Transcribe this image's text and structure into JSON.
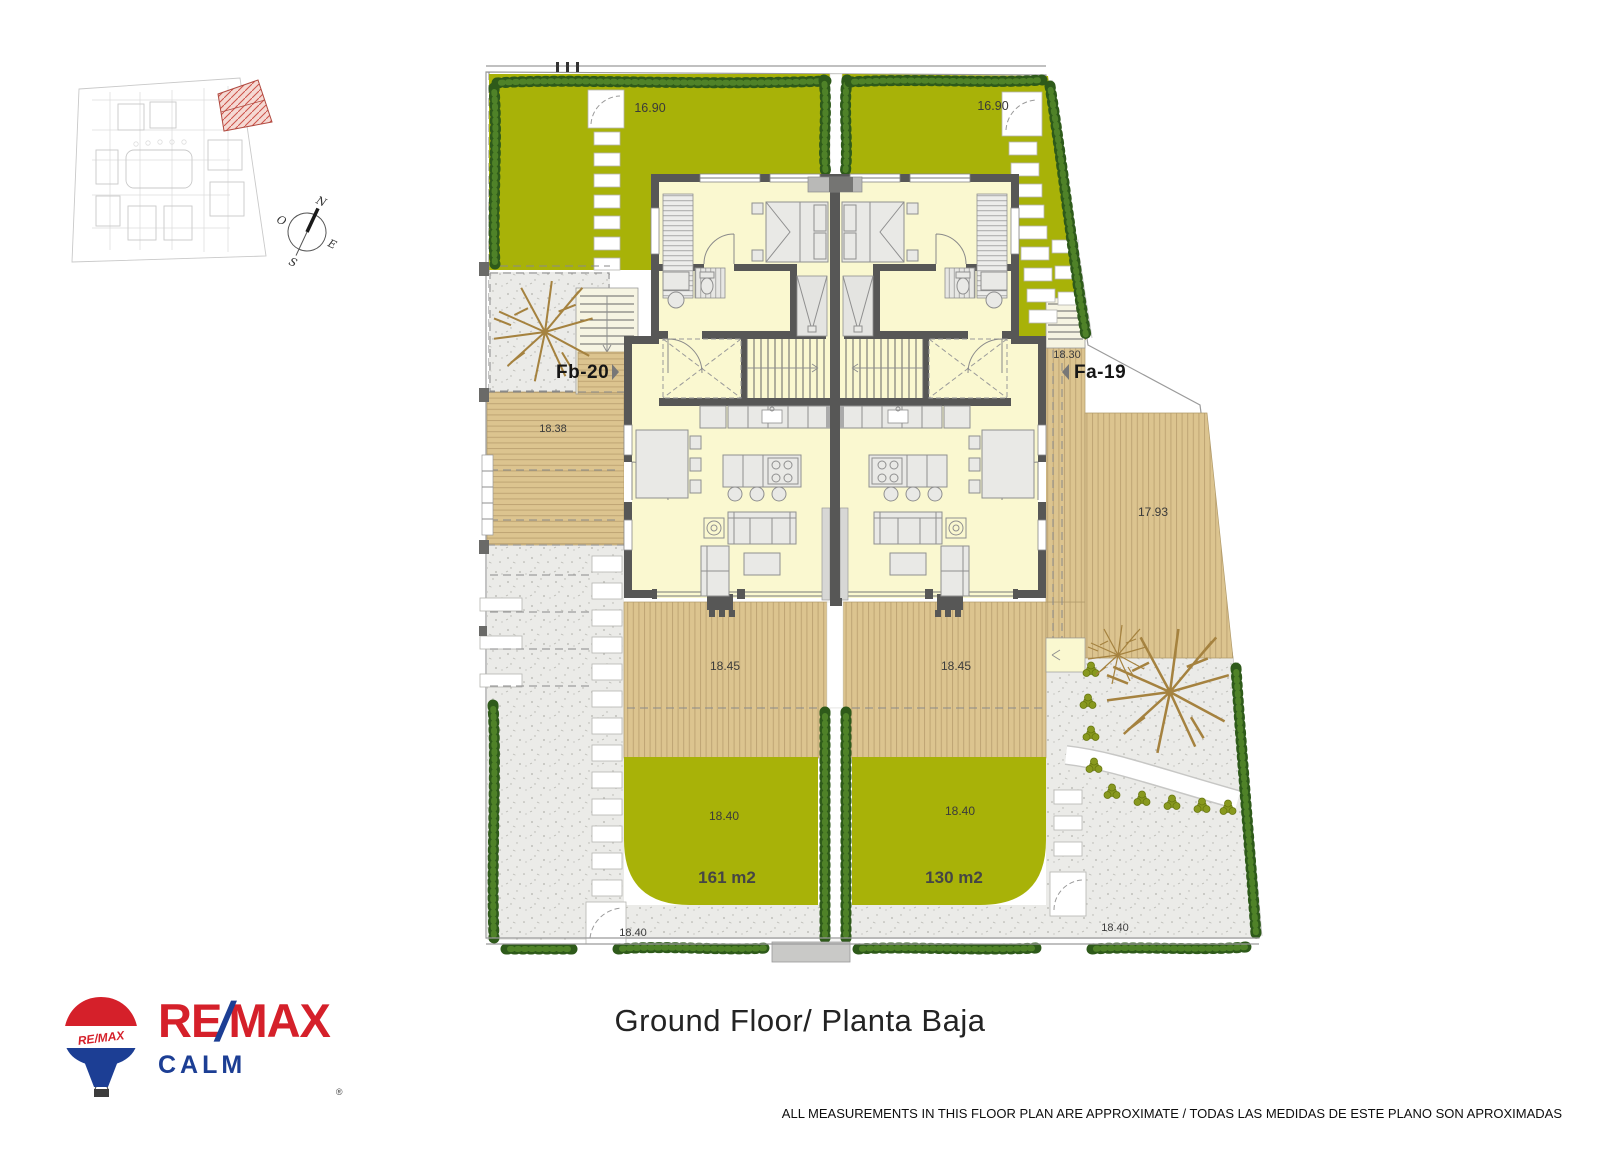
{
  "footer": {
    "title": "Ground Floor/ Planta Baja",
    "disclaimer": "ALL MEASUREMENTS IN THIS FLOOR PLAN ARE APPROXIMATE / TODAS LAS MEDIDAS DE ESTE PLANO SON APROXIMADAS"
  },
  "logo": {
    "re": "RE",
    "slash": "/",
    "max": "MAX",
    "office": "CALM",
    "balloon_text": "RE/MAX",
    "registered": "®"
  },
  "compass": {
    "n": "N",
    "s": "S",
    "e": "E",
    "o": "O"
  },
  "plan": {
    "labels": {
      "garden_left": "16.90",
      "garden_right": "16.90",
      "unit_left": "Fb-20",
      "unit_right": "Fa-19",
      "deck_left": "18.38",
      "entry_right": "18.30",
      "deck_right": "17.93",
      "terrace_left": "18.45",
      "terrace_right": "18.45",
      "lawn_left": "18.40",
      "lawn_right": "18.40",
      "area_left": "161 m2",
      "area_right": "130 m2",
      "gravel_left": "18.40",
      "gravel_right": "18.40"
    },
    "colors": {
      "lawn": "#a8b208",
      "hedge": "#2e5a1a",
      "deck": "#dcc48f",
      "deck_stripe": "#bfa574",
      "gravel": "#ebebe8",
      "interior": "#faf8d0",
      "wall": "#575756",
      "site_highlight": "#cc5148",
      "brand_red": "#d5202a",
      "brand_blue": "#1c3e94"
    }
  }
}
